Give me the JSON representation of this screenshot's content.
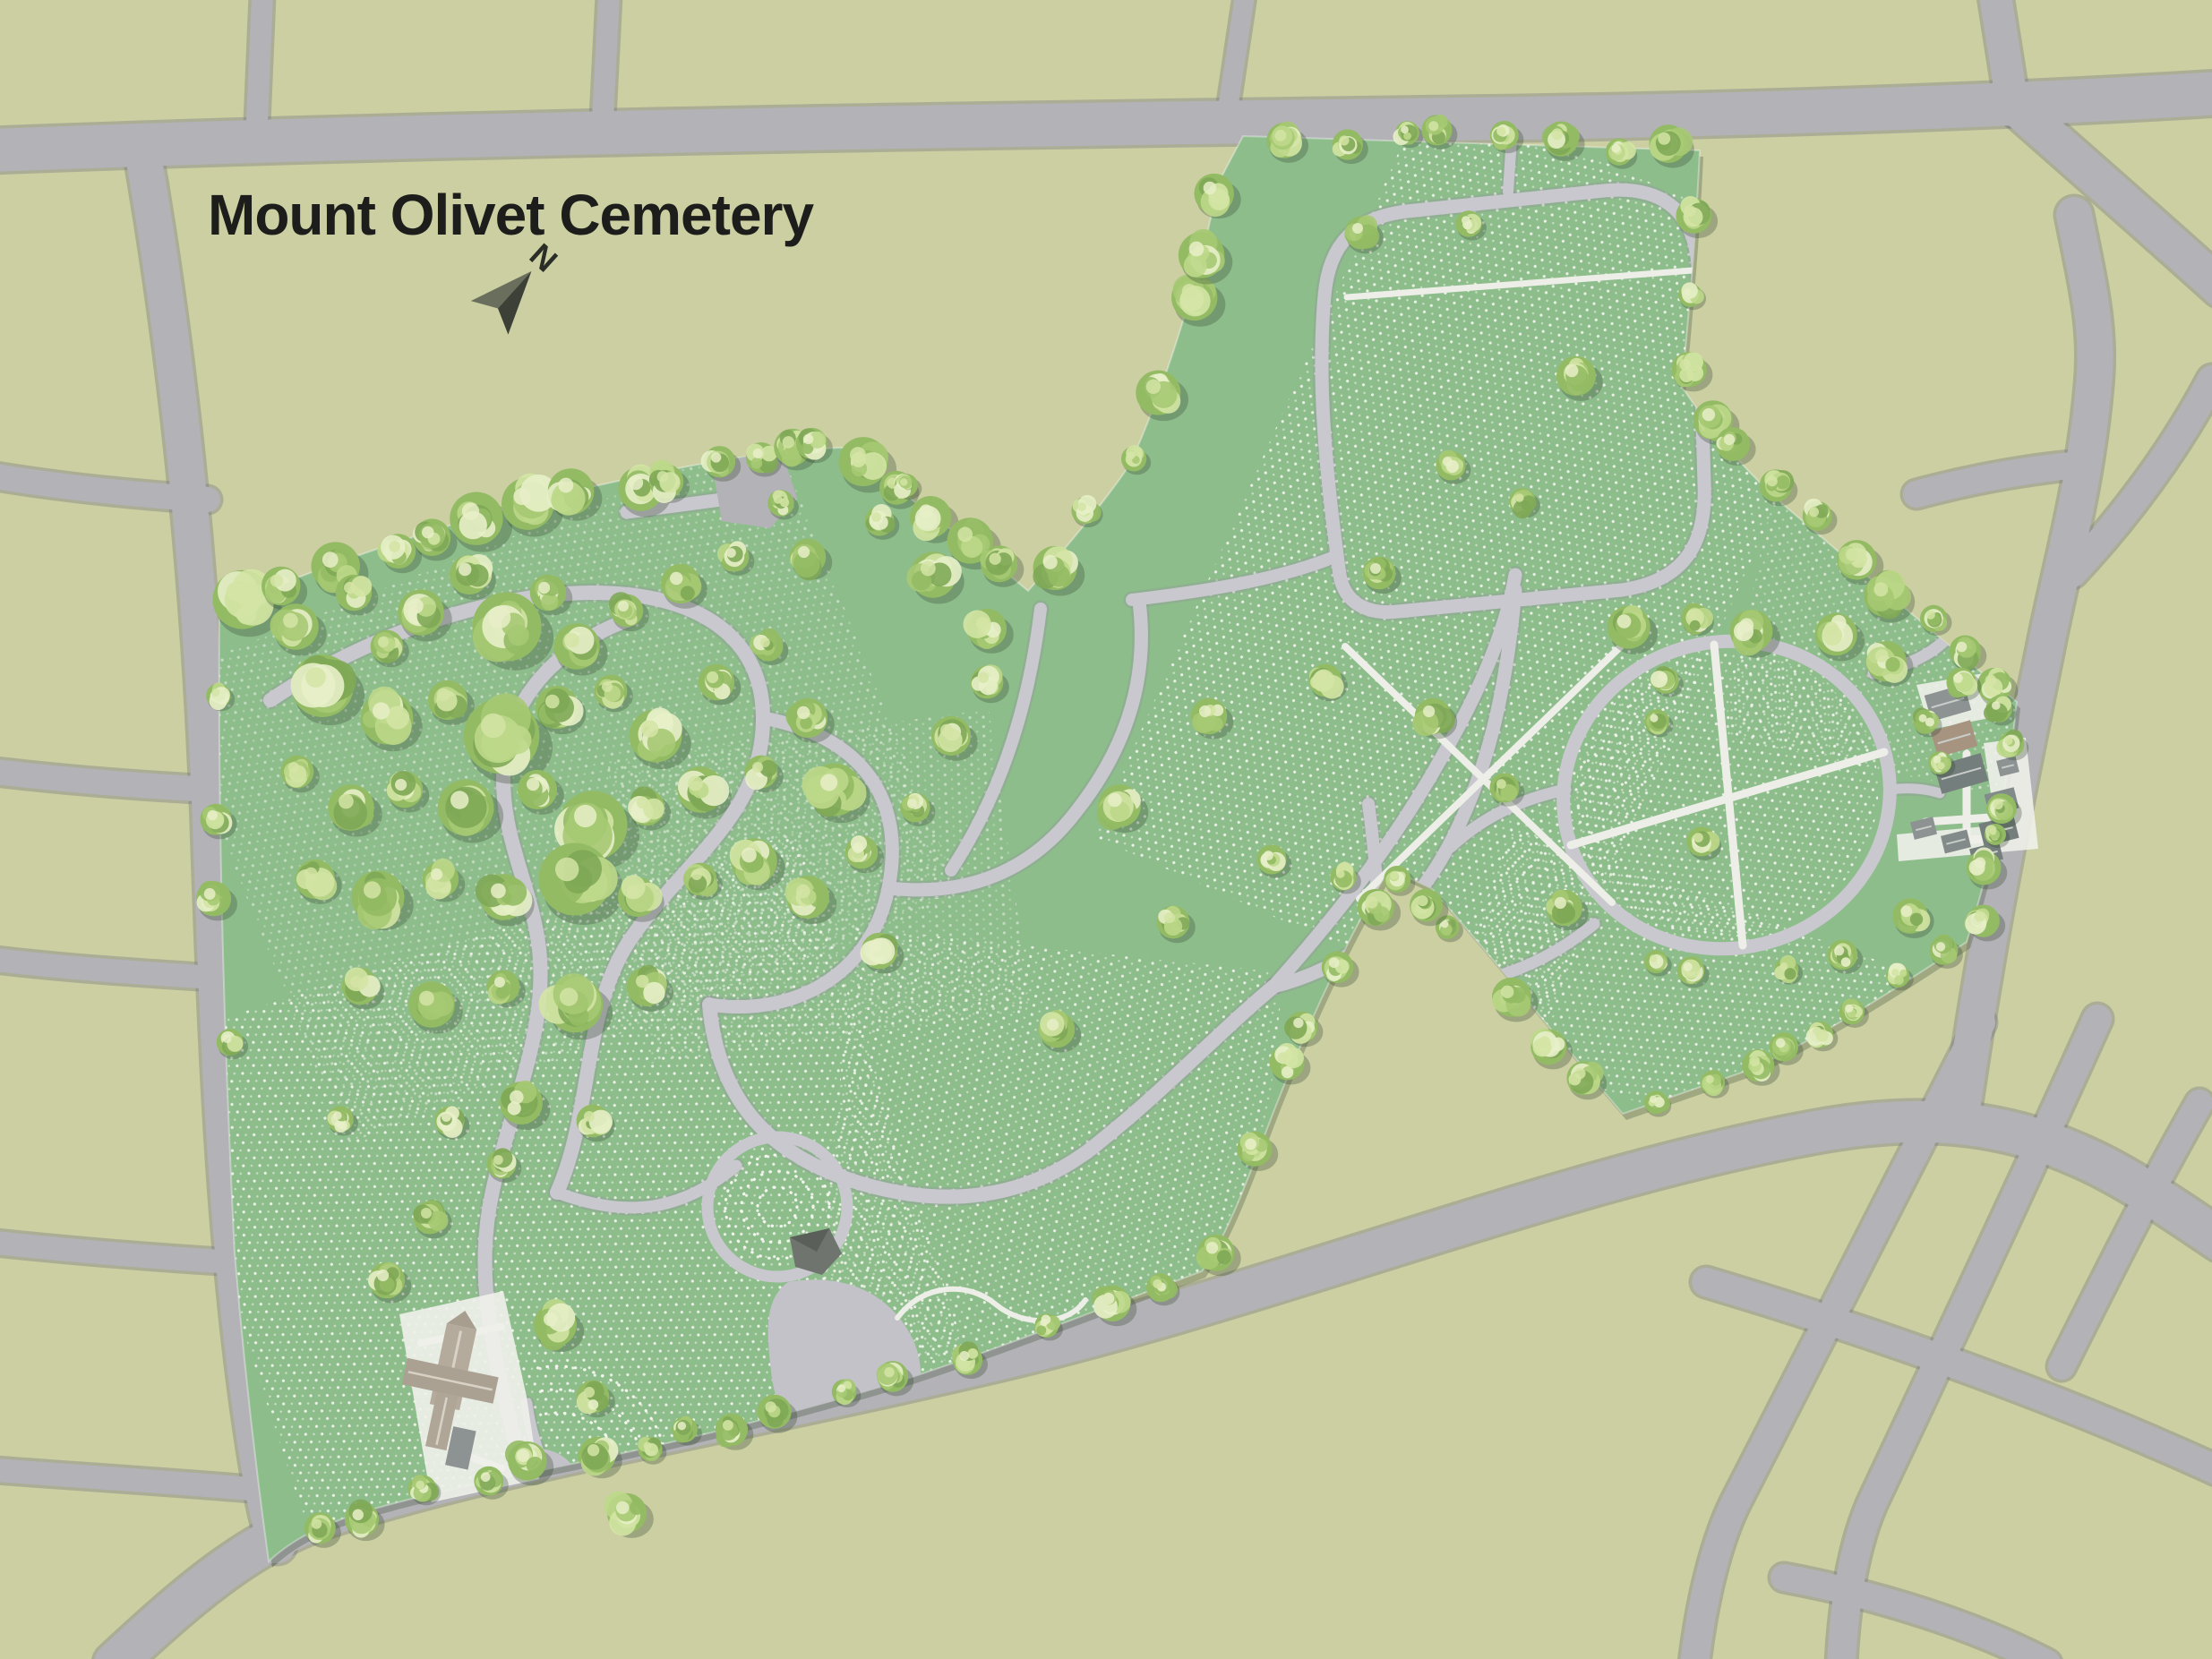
{
  "title": "Mount Olivet Cemetery",
  "compass": {
    "label": "N"
  },
  "colors": {
    "surroundings": "#cbcfa2",
    "road": "#b3b2b7",
    "road_edge": "rgba(122,122,130,0.40)",
    "cemetery": "#8ebd8c",
    "cemetery_shadow": "rgba(70,88,62,0.32)",
    "cemetery_outline": "rgba(255,255,255,0.35)",
    "internal_road": "#c9c8cf",
    "internal_road_edge": "rgba(145,147,156,0.32)",
    "walkway": "#edeee7",
    "grave_dot": "#f4f5ef",
    "plaza": "#c3c2c9",
    "tree_palette": [
      "#7fa957",
      "#93bb64",
      "#a6c973",
      "#bcd88a",
      "#d3e4a4",
      "#e7efc8"
    ],
    "tree_shadow": "rgba(50,70,45,0.30)",
    "building_pad": "#eff0ea",
    "roof_gray": "#8c9392",
    "roof_gray_mid": "#828b89",
    "roof_gray_dark": "#747e7c",
    "roof_brown": "#a69380",
    "roof_tan": "#b5ab9d",
    "roof_tan_dark": "#a89e90",
    "roof_ridge": "#d8d2c6",
    "mausoleum": "#6f756e",
    "mausoleum_dark": "#5a6059",
    "title_text": "#1d1d1b",
    "north_dark": "#3c4036",
    "north_light": "#6a6f5d",
    "north_text": "#2b2e27"
  }
}
